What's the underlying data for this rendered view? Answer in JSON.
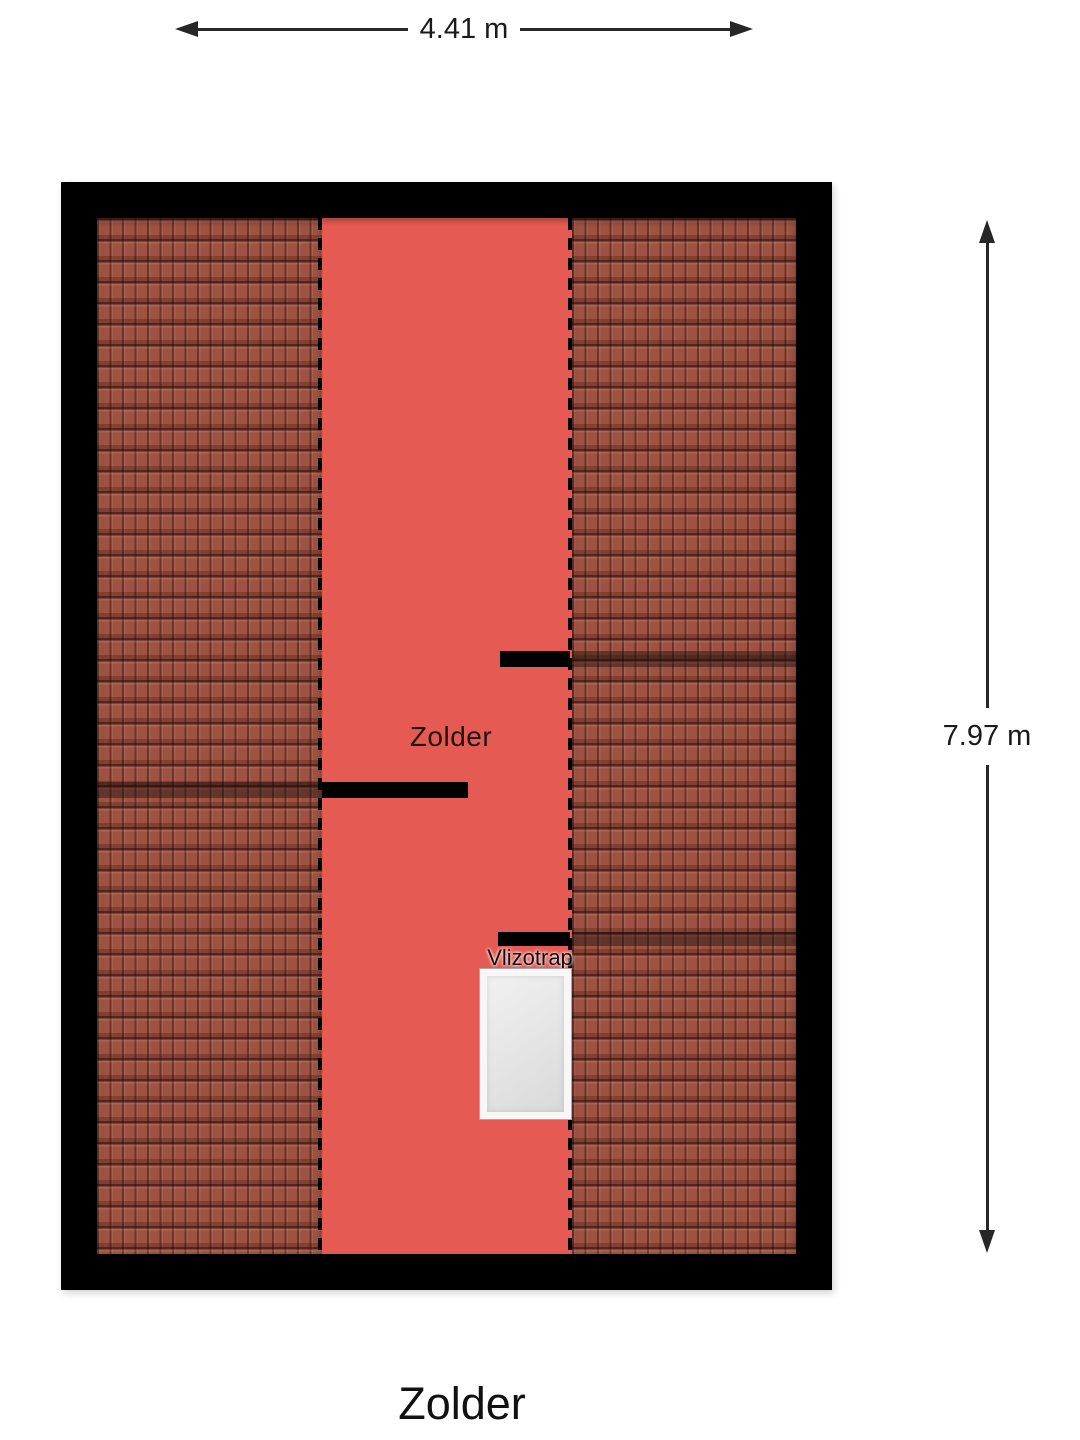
{
  "floorplan": {
    "room_label": "Zolder",
    "hatch_label": "Vlizotrap",
    "width_dimension_label": "4.41 m",
    "height_dimension_label": "7.97 m",
    "footer_title": "Zolder"
  },
  "colors": {
    "floor": "#E55B53",
    "roof-tile": "#9E5342",
    "wall": "#000000",
    "hatch-fill": "#E4E4E4",
    "hatch-border": "#F7F7F7",
    "dimension": "#272727",
    "title-text": "#111111"
  }
}
